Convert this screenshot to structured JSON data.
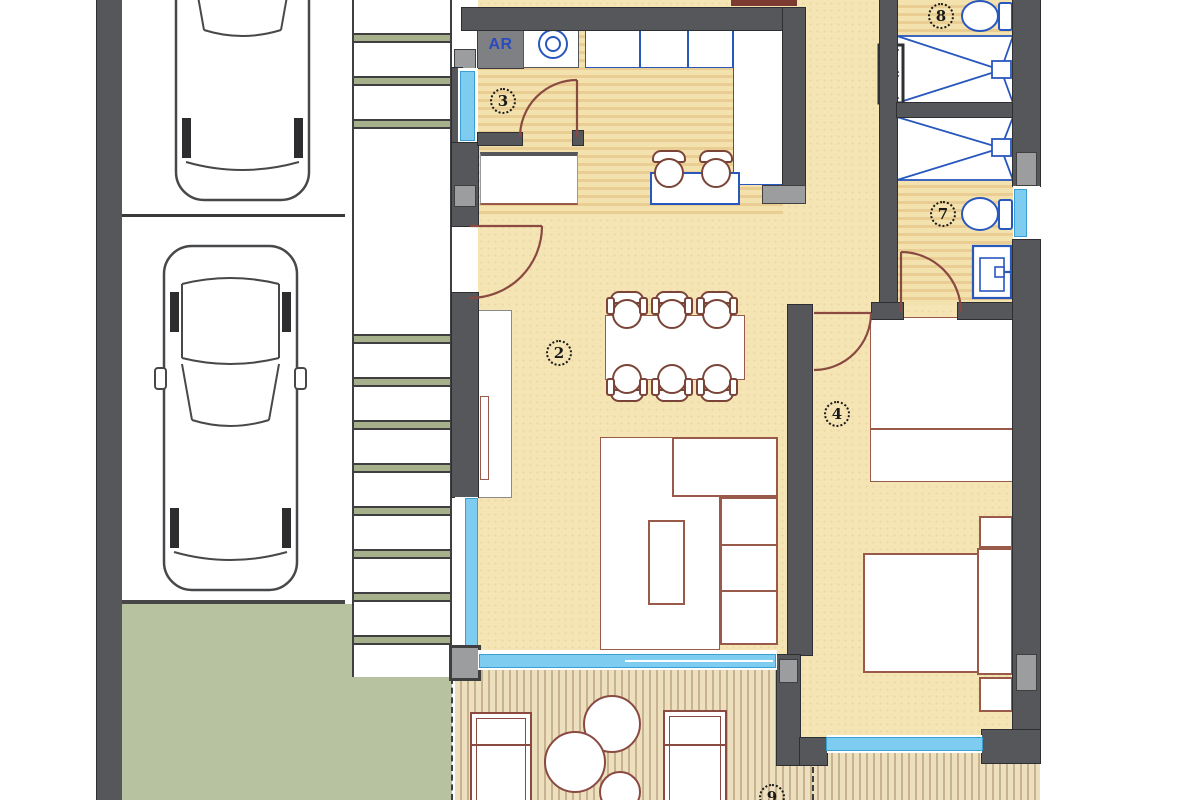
{
  "plan": {
    "title": "apartment-floor-plan",
    "labels": {
      "laundry_closet": "AR"
    },
    "room_numbers": {
      "living_dining": "2",
      "kitchen": "3",
      "bedroom": "4",
      "bathroom_2": "7",
      "bathroom_1": "8",
      "terrace": "9"
    },
    "site": {
      "parking_spaces": 2,
      "cars": 2,
      "garden": "lawn-bottom-left",
      "stairs": "exterior-staircase-strip"
    },
    "symbols": [
      "car-top-view",
      "staircase-treads",
      "washing-machine",
      "kitchen-sink",
      "cooktop-4-burner",
      "breakfast-bar-stool",
      "dining-table-6-chairs",
      "sofa-with-rug",
      "coffee-table",
      "tv-cabinet",
      "double-bed",
      "nightstand",
      "wardrobe",
      "shower-tray",
      "toilet",
      "washbasin",
      "duct-column",
      "door-swing-arc",
      "sliding-glass-door",
      "lounge-chair",
      "round-side-table"
    ],
    "colors": {
      "floor_beige": "#f6e5b4",
      "floor_stripe": "#e9cd92",
      "wall_dark": "#56575b",
      "wall_light": "#9c9d9f",
      "fixture_blue": "#2857be",
      "window_blue": "#7ecdf0",
      "furniture_brown": "#9a5a4a",
      "door_arc_brown": "#8a4a42",
      "garden_green": "#b7c2a0",
      "deck_tan": "#ece0bf",
      "label_blue": "#2b4bbf"
    }
  }
}
